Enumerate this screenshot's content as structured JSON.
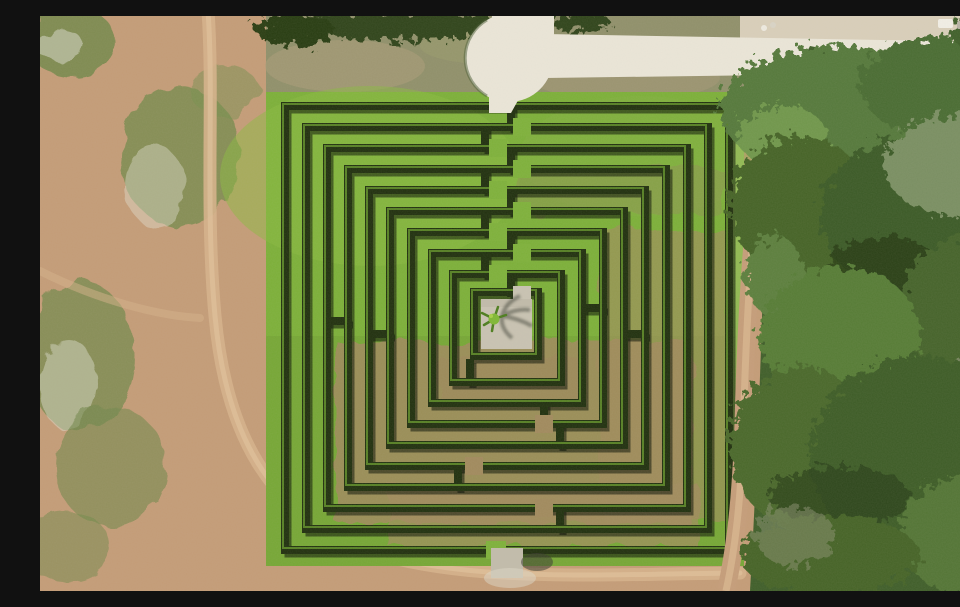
{
  "scene": {
    "type": "aerial-drone-photo",
    "subject": "Square hedge maze (labyrinth) of about ten concentric clipped-hedge circuits",
    "center_feature": "Light concrete plaza with a single palm tree casting a feathered shadow",
    "entrance": "White sand path entering the top wall from a cul-de-sac loop on an access road",
    "exit": "Small gap in the bottom wall with a grey concrete pad leading to a dirt track",
    "surroundings_left": "Bare reddish sand field with weedy green patches and wheel tracks",
    "surroundings_right": "Dense woodland strip with a dirt track running along its edge",
    "surroundings_top": "Scrubby olive field crossed by a white access road running to the right edge",
    "path_condition": "Maze lanes bright green in the upper half, worn brown grass in the lower half"
  },
  "colors": {
    "dirt": "#c49c77",
    "dirt_track": "#d6b18a",
    "scrub_field": "#90906a",
    "lawn": "#7cb038",
    "lawn_shade": "#6f9e33",
    "path_brown": "#a18a5d",
    "hedge": "#20300e",
    "hedge_shadow": "#0a1004",
    "hedge_highlight": "#6da32d",
    "road": "#ebe6d8",
    "concrete": "#c9c3b2",
    "forest": "#3f5e29",
    "canopy_light": "#6f974b",
    "pale_ground": "#d9cfba",
    "palm": "#7fb834"
  }
}
